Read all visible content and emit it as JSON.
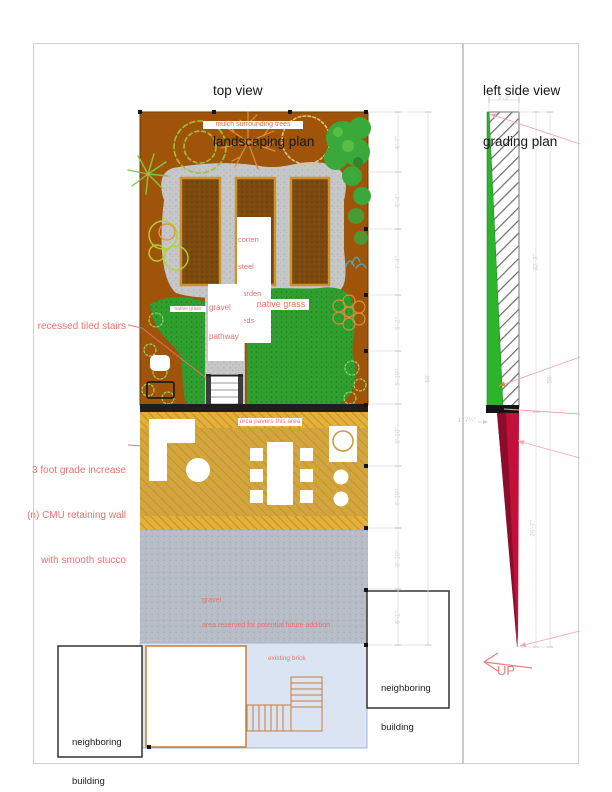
{
  "titles": {
    "plan": [
      "top view",
      "landscaping plan"
    ],
    "grading": [
      "left side view",
      "grading plan"
    ]
  },
  "callouts": {
    "stairs": "recessed tiled stairs",
    "grade_lines": [
      "3 foot grade increase",
      "(n) CMU retaining wall",
      "with smooth stucco"
    ]
  },
  "plan_labels": {
    "mulch": "mulch surrounding trees",
    "corten_lines": [
      "corten",
      "steel",
      "garden",
      "beds"
    ],
    "gravel_path_lines": [
      "gravel",
      "pathway"
    ],
    "native_grass_small": "native grass",
    "native_grass": "native grass",
    "pavers": "orca pavers this area",
    "future_lines": [
      "gravel",
      "area reserved for potential future addition"
    ],
    "existing_brick": "existing brick",
    "neighboring_lines": [
      "neighboring",
      "building"
    ]
  },
  "grading_labels": {
    "up": "UP"
  },
  "dimensions": {
    "plan_segments": [
      "6'-7\"",
      "6'-4\"",
      "7'-4\"",
      "6'-2\"",
      "5'-10\"",
      "6'-10\"",
      "6'-10\"",
      "6'-10\"",
      "6'-1\""
    ],
    "plan_total": "59'",
    "side_width_top": "3'-3\"",
    "side_upper": "32'-3\"",
    "side_lower": "26'-7\"",
    "side_total": "59'",
    "side_wall_width": "1'-7½\""
  },
  "colors": {
    "mulch": "#a4570b",
    "garden_bed": "#7d4a0e",
    "gravel": "#c6c7c9",
    "grass": "#2f9f2f",
    "pavers_gold": "#d2a63c",
    "concrete": "#b7bdc7",
    "annotation_red": "#e8736f",
    "slope_green": "#2cb52c",
    "slope_red": "#c11039"
  }
}
